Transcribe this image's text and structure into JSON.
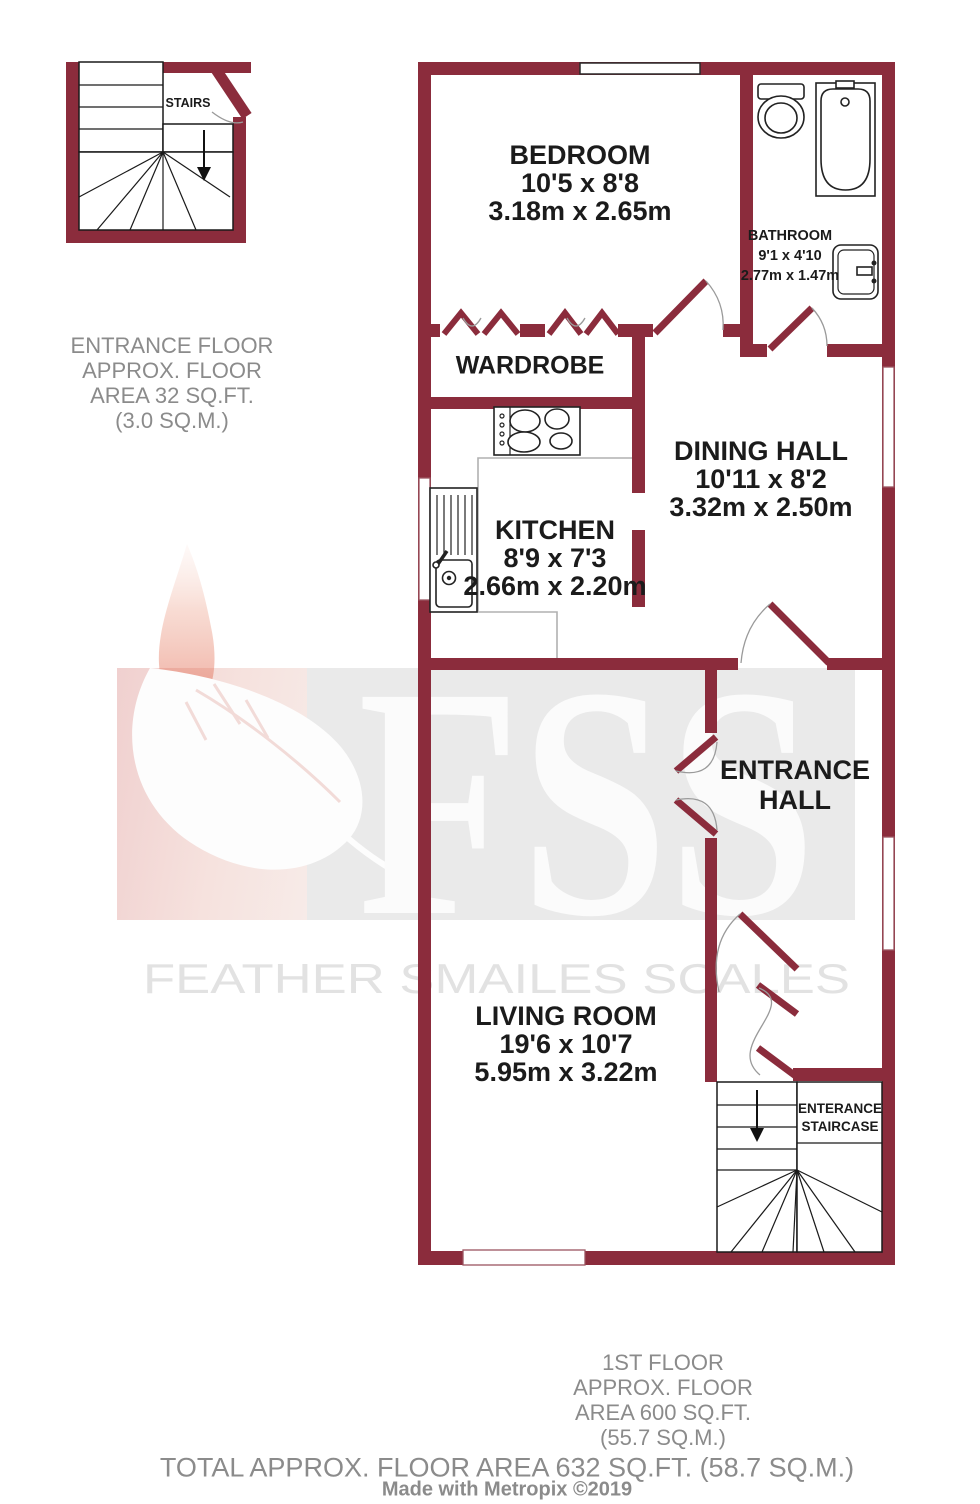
{
  "colors": {
    "wall": "#8B2C3C",
    "label_text": "#1b1b1b",
    "muted_text": "#8b8b8b",
    "watermark_box": "#eaeaea",
    "watermark_text": "#e2e2e2",
    "watermark_logo": "#fbfbfb"
  },
  "watermark": {
    "logo": "FSS",
    "company": "FEATHER SMAILES SCALES"
  },
  "upper_stairs": {
    "label": "STAIRS"
  },
  "rooms": {
    "bedroom": {
      "name": "BEDROOM",
      "imperial": "10'5 x 8'8",
      "metric": "3.18m x 2.65m"
    },
    "bathroom": {
      "name": "BATHROOM",
      "imperial": "9'1 x 4'10",
      "metric": "2.77m x 1.47m"
    },
    "wardrobe": {
      "name": "WARDROBE"
    },
    "kitchen": {
      "name": "KITCHEN",
      "imperial": "8'9 x 7'3",
      "metric": "2.66m x 2.20m"
    },
    "dining_hall": {
      "name": "DINING HALL",
      "imperial": "10'11 x 8'2",
      "metric": "3.32m x 2.50m"
    },
    "entrance_hall": {
      "line1": "ENTRANCE",
      "line2": "HALL"
    },
    "living_room": {
      "name": "LIVING ROOM",
      "imperial": "19'6 x 10'7",
      "metric": "5.95m x 3.22m"
    },
    "staircase": {
      "line1": "ENTERANCE",
      "line2": "STAIRCASE"
    }
  },
  "annotations": {
    "entrance_floor": [
      "ENTRANCE FLOOR",
      "APPROX. FLOOR",
      "AREA 32 SQ.FT.",
      "(3.0 SQ.M.)"
    ],
    "first_floor": [
      "1ST FLOOR",
      "APPROX. FLOOR",
      "AREA 600 SQ.FT.",
      "(55.7 SQ.M.)"
    ],
    "total": "TOTAL APPROX. FLOOR AREA 632 SQ.FT. (58.7 SQ.M.)",
    "credit": "Made with Metropix ©2019"
  }
}
